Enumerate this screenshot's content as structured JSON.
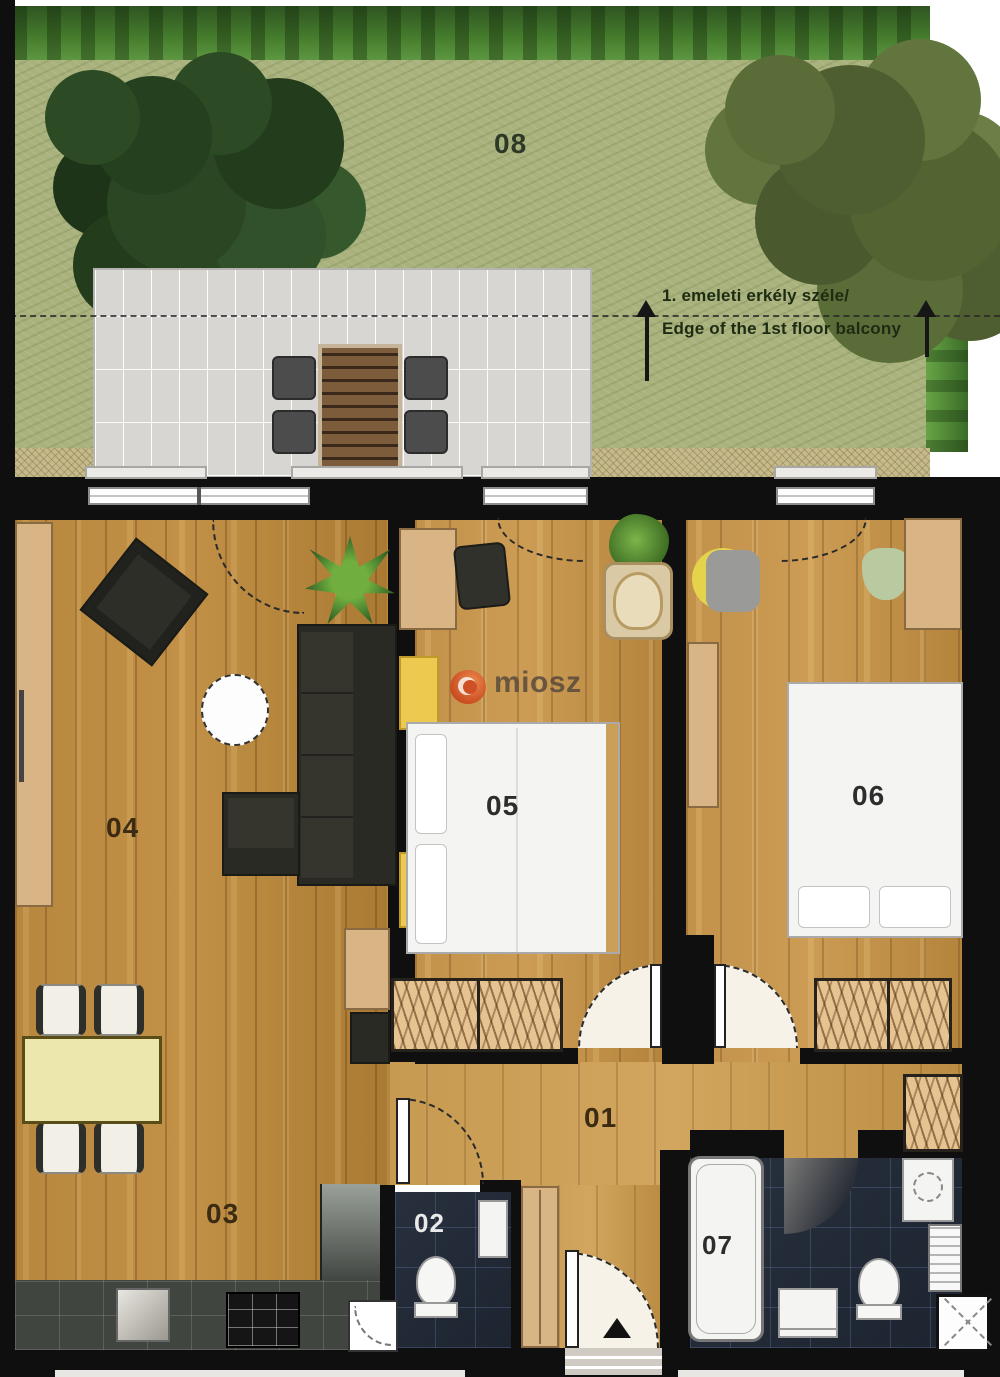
{
  "watermark": {
    "text": "miosz"
  },
  "garden": {
    "annotation": {
      "line1": "1. emeleti erkély széle/",
      "line2": "Edge of the 1st floor balcony"
    }
  },
  "rooms": {
    "hall": {
      "label": "01"
    },
    "wc": {
      "label": "02"
    },
    "dining": {
      "label": "03"
    },
    "living": {
      "label": "04"
    },
    "bedroom_1": {
      "label": "05"
    },
    "bedroom_2": {
      "label": "06"
    },
    "bathroom": {
      "label": "07"
    },
    "garden": {
      "label": "08"
    }
  },
  "colors": {
    "wall": "#0f0f0f",
    "wood": "#b8873e",
    "wood_light": "#c79a52",
    "dark_tile": "#232b38",
    "grass": "#a9b27c",
    "terrace": "#d8d6d2",
    "accent_orange": "#ce4a20"
  }
}
